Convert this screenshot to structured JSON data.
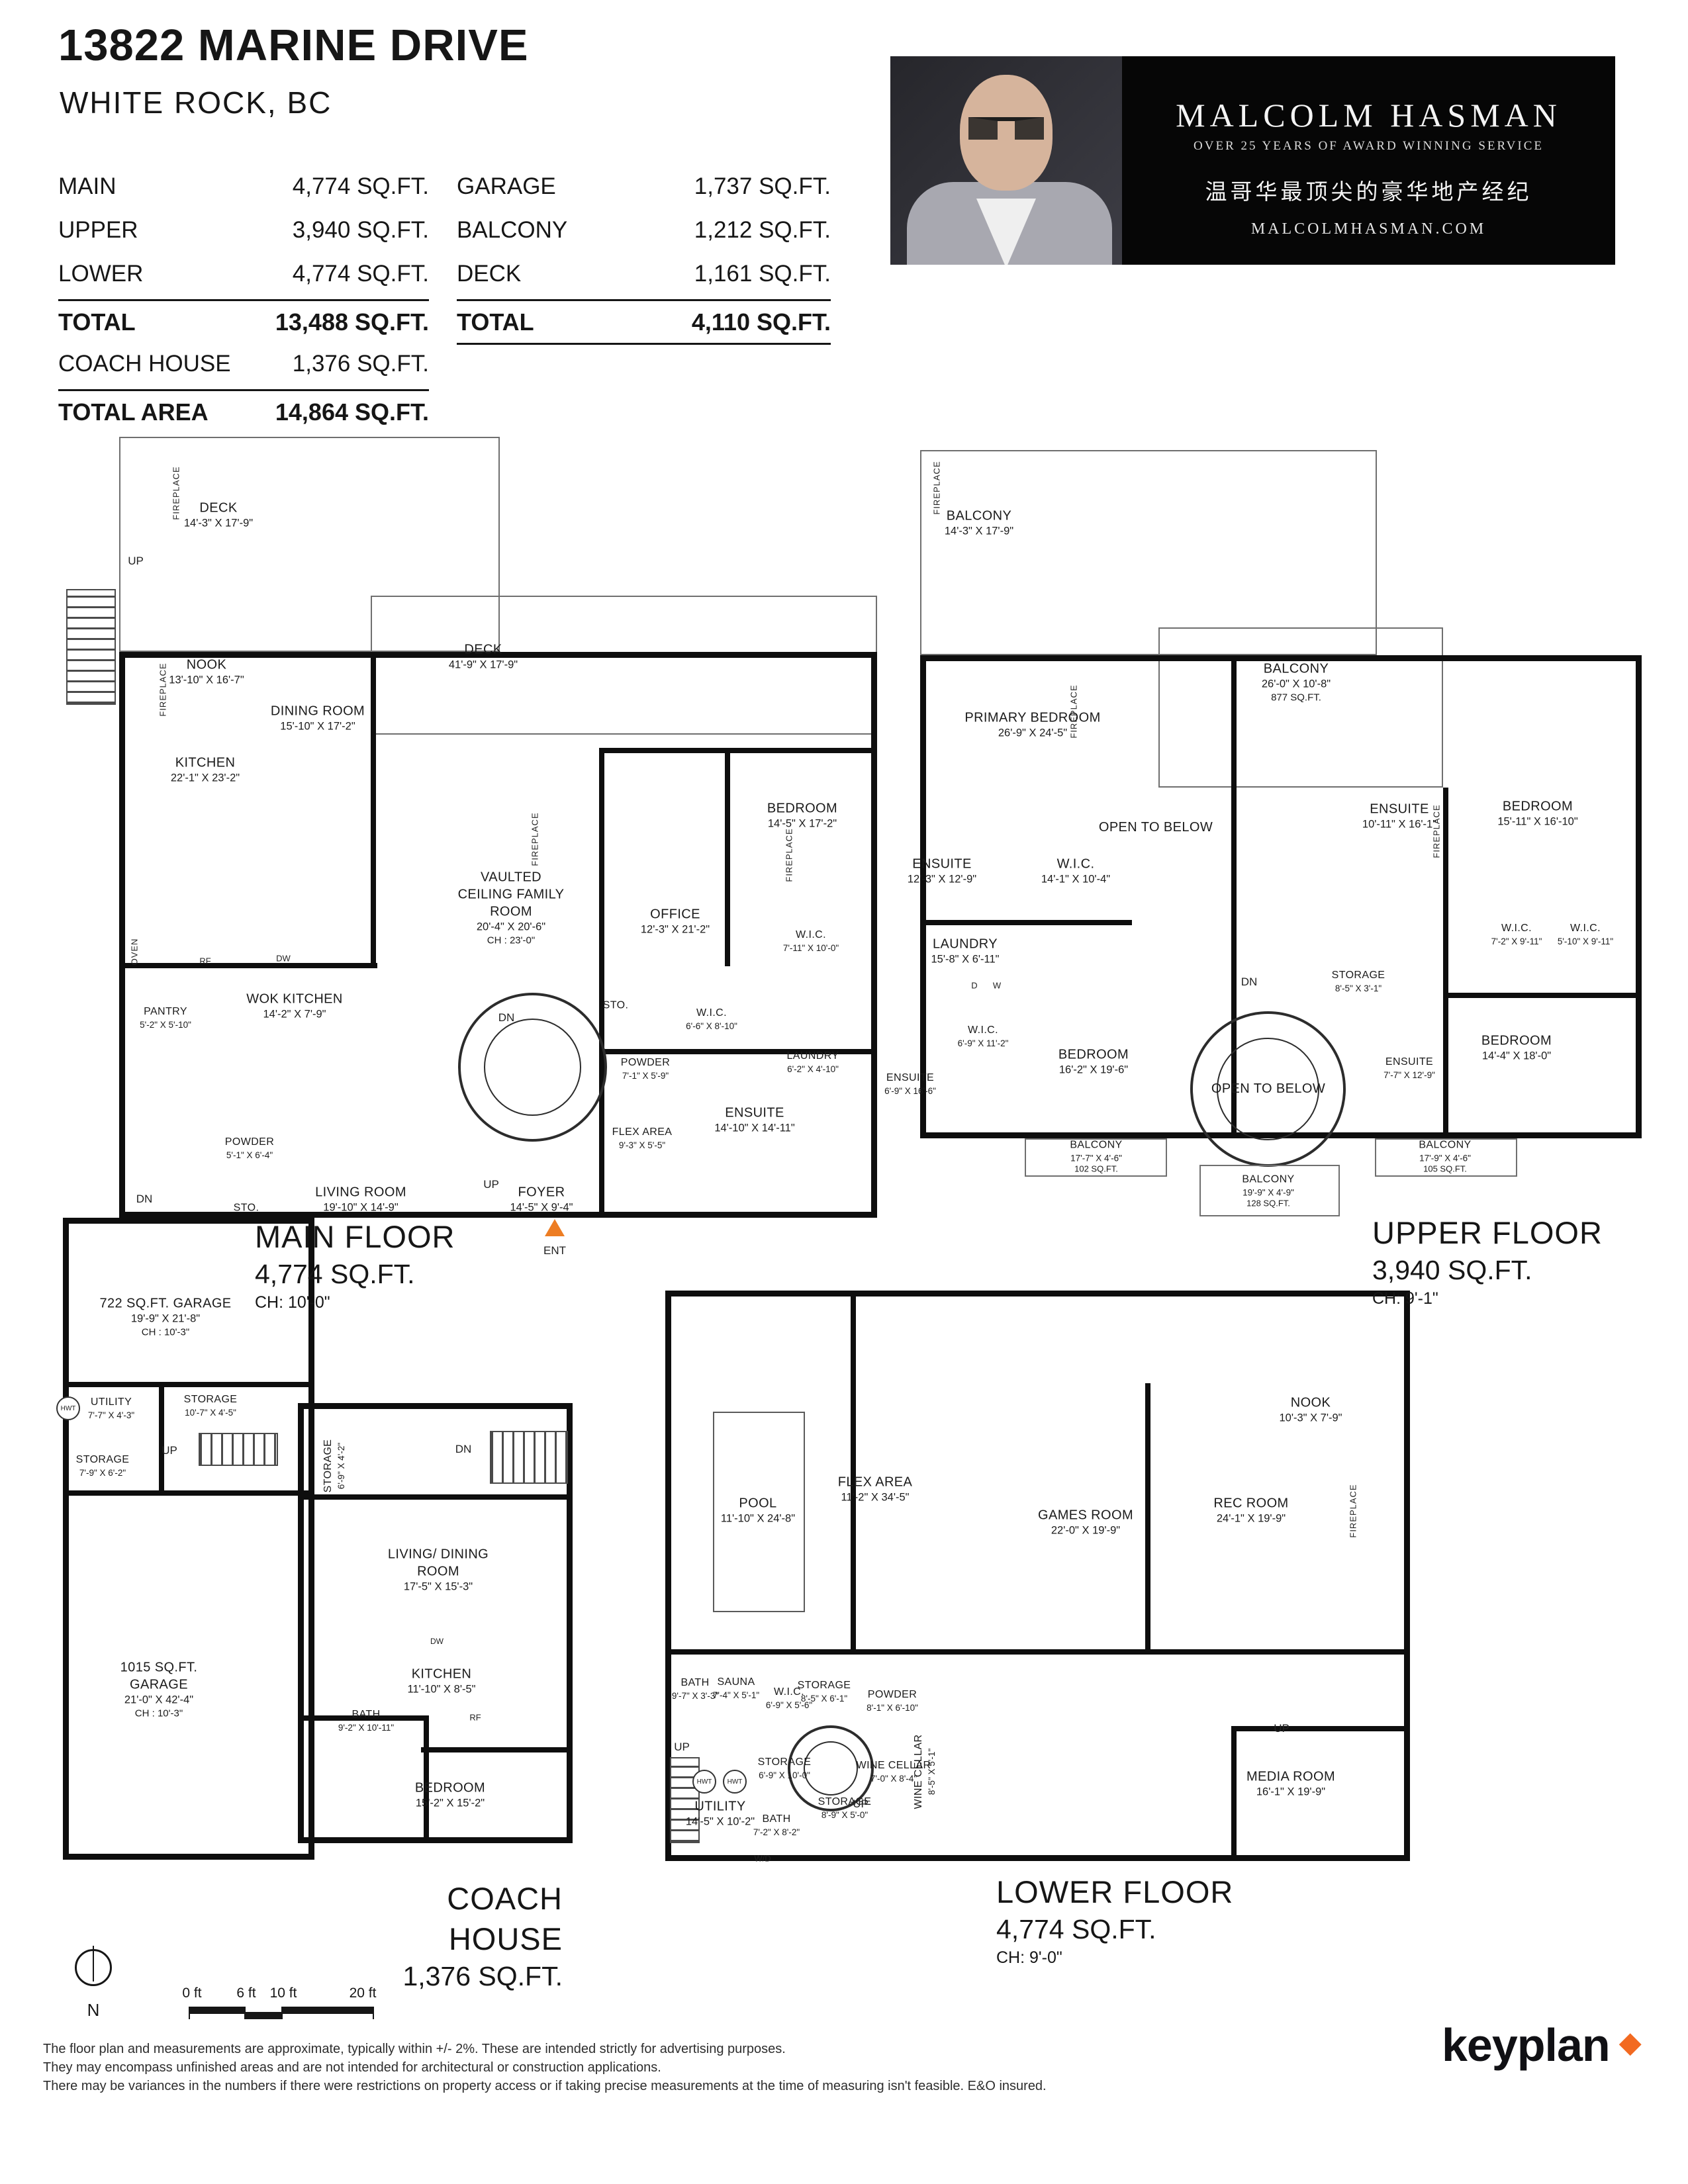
{
  "colors": {
    "accent_orange": "#ed7d23",
    "banner_bg": "#060606"
  },
  "header": {
    "title": "13822 MARINE DRIVE",
    "subtitle": "WHITE ROCK, BC",
    "left_table": {
      "rows": [
        {
          "label": "MAIN",
          "value": "4,774 SQ.FT."
        },
        {
          "label": "UPPER",
          "value": "3,940 SQ.FT."
        },
        {
          "label": "LOWER",
          "value": "4,774 SQ.FT."
        }
      ],
      "total": {
        "label": "TOTAL",
        "value": "13,488 SQ.FT."
      },
      "coach": {
        "label": "COACH HOUSE",
        "value": "1,376 SQ.FT."
      },
      "total_area": {
        "label": "TOTAL AREA",
        "value": "14,864 SQ.FT."
      }
    },
    "right_table": {
      "rows": [
        {
          "label": "GARAGE",
          "value": "1,737 SQ.FT."
        },
        {
          "label": "BALCONY",
          "value": "1,212 SQ.FT."
        },
        {
          "label": "DECK",
          "value": "1,161 SQ.FT."
        }
      ],
      "total": {
        "label": "TOTAL",
        "value": "4,110 SQ.FT."
      }
    }
  },
  "banner": {
    "name": "MALCOLM HASMAN",
    "tagline": "OVER 25 YEARS OF AWARD WINNING SERVICE",
    "tagline_cn": "温哥华最顶尖的豪华地产经纪",
    "website": "MALCOLMHASMAN.COM"
  },
  "floors": {
    "main": {
      "title": "MAIN FLOOR",
      "area": "4,774 SQ.FT.",
      "ceiling": "CH: 10'-0\"",
      "rooms": [
        {
          "name": "DECK",
          "dims": "14'-3\" X 17'-9\""
        },
        {
          "name": "NOOK",
          "dims": "13'-10\" X 16'-7\""
        },
        {
          "name": "DINING ROOM",
          "dims": "15'-10\" X 17'-2\""
        },
        {
          "name": "KITCHEN",
          "dims": "22'-1\" X 23'-2\""
        },
        {
          "name": "DECK",
          "dims": "41'-9\" X 17'-9\""
        },
        {
          "name": "VAULTED CEILING FAMILY ROOM",
          "dims": "20'-4\" X 20'-6\"",
          "extra": "CH : 23'-0\""
        },
        {
          "name": "OFFICE",
          "dims": "12'-3\" X 21'-2\""
        },
        {
          "name": "BEDROOM",
          "dims": "14'-5\" X 17'-2\""
        },
        {
          "name": "W.I.C.",
          "dims": "7'-11\" X 10'-0\""
        },
        {
          "name": "WOK KITCHEN",
          "dims": "14'-2\" X 7'-9\""
        },
        {
          "name": "PANTRY",
          "dims": "5'-2\" X 5'-10\""
        },
        {
          "name": "POWDER",
          "dims": "5'-1\" X 6'-4\""
        },
        {
          "name": "STO."
        },
        {
          "name": "LIVING ROOM",
          "dims": "19'-10\" X 14'-9\""
        },
        {
          "name": "FOYER",
          "dims": "14'-5\" X 9'-4\""
        },
        {
          "name": "FLEX AREA",
          "dims": "9'-3\" X 5'-5\""
        },
        {
          "name": "STO."
        },
        {
          "name": "W.I.C.",
          "dims": "6'-6\" X 8'-10\""
        },
        {
          "name": "POWDER",
          "dims": "7'-1\" X 5'-9\""
        },
        {
          "name": "LAUNDRY",
          "dims": "6'-2\" X 4'-10\""
        },
        {
          "name": "ENSUITE",
          "dims": "14'-10\" X 14'-11\""
        }
      ],
      "markers": [
        "UP",
        "DN",
        "UP",
        "DN",
        "ENT",
        "RF",
        "DW",
        "OVEN",
        "FIREPLACE",
        "FIREPLACE",
        "FIREPLACE",
        "FIREPLACE"
      ]
    },
    "upper": {
      "title": "UPPER FLOOR",
      "area": "3,940 SQ.FT.",
      "ceiling": "CH: 9'-1\"",
      "rooms": [
        {
          "name": "BALCONY",
          "dims": "14'-3\" X 17'-9\""
        },
        {
          "name": "PRIMARY BEDROOM",
          "dims": "26'-9\" X 24'-5\""
        },
        {
          "name": "BALCONY",
          "dims": "26'-0\" X 10'-8\"",
          "extra": "877 SQ.FT."
        },
        {
          "name": "ENSUITE",
          "dims": "10'-11\" X 16'-1\""
        },
        {
          "name": "BEDROOM",
          "dims": "15'-11\" X 16'-10\""
        },
        {
          "name": "OPEN TO BELOW"
        },
        {
          "name": "ENSUITE",
          "dims": "12'-3\" X 12'-9\""
        },
        {
          "name": "W.I.C.",
          "dims": "14'-1\" X 10'-4\""
        },
        {
          "name": "LAUNDRY",
          "dims": "15'-8\" X 6'-11\""
        },
        {
          "name": "STORAGE",
          "dims": "8'-5\" X 3'-1\""
        },
        {
          "name": "W.I.C.",
          "dims": "7'-2\" X 9'-11\""
        },
        {
          "name": "W.I.C.",
          "dims": "5'-10\" X 9'-11\""
        },
        {
          "name": "W.I.C.",
          "dims": "6'-9\" X 11'-2\""
        },
        {
          "name": "ENSUITE",
          "dims": "6'-9\" X 16'-6\""
        },
        {
          "name": "BEDROOM",
          "dims": "16'-2\" X 19'-6\""
        },
        {
          "name": "OPEN TO BELOW"
        },
        {
          "name": "ENSUITE",
          "dims": "7'-7\" X 12'-9\""
        },
        {
          "name": "BEDROOM",
          "dims": "14'-4\" X 18'-0\""
        },
        {
          "name": "BALCONY",
          "dims": "17'-7\" X 4'-6\"",
          "extra": "102 SQ.FT."
        },
        {
          "name": "BALCONY",
          "dims": "19'-9\" X 4'-9\"",
          "extra": "128 SQ.FT."
        },
        {
          "name": "BALCONY",
          "dims": "17'-9\" X 4'-6\"",
          "extra": "105 SQ.FT."
        }
      ],
      "markers": [
        "DN",
        "D",
        "W",
        "FIREPLACE",
        "FIREPLACE",
        "FIREPLACE"
      ]
    },
    "coach": {
      "title": "COACH HOUSE",
      "area": "1,376 SQ.FT.",
      "rooms": [
        {
          "name": "STORAGE",
          "dims": "6'-9\" X 4'-2\""
        },
        {
          "name": "LIVING/ DINING ROOM",
          "dims": "17'-5\" X 15'-3\""
        },
        {
          "name": "KITCHEN",
          "dims": "11'-10\" X 8'-5\""
        },
        {
          "name": "BATH",
          "dims": "9'-2\" X 10'-11\""
        },
        {
          "name": "BEDROOM",
          "dims": "15'-2\" X 15'-2\""
        }
      ],
      "markers": [
        "DN",
        "DW",
        "RF"
      ]
    },
    "garage": {
      "rooms": [
        {
          "name": "722 SQ.FT. GARAGE",
          "dims": "19'-9\" X 21'-8\"",
          "extra": "CH : 10'-3\""
        },
        {
          "name": "UTILITY",
          "dims": "7'-7\" X 4'-3\""
        },
        {
          "name": "STORAGE",
          "dims": "10'-7\" X 4'-5\""
        },
        {
          "name": "STORAGE",
          "dims": "7'-9\" X 6'-2\""
        },
        {
          "name": "1015 SQ.FT. GARAGE",
          "dims": "21'-0\" X 42'-4\"",
          "extra": "CH : 10'-3\""
        }
      ],
      "markers": [
        "UP",
        "HWT"
      ]
    },
    "lower": {
      "title": "LOWER FLOOR",
      "area": "4,774 SQ.FT.",
      "ceiling": "CH: 9'-0\"",
      "rooms": [
        {
          "name": "POOL",
          "dims": "11'-10\" X 24'-8\""
        },
        {
          "name": "FLEX AREA",
          "dims": "11'-2\" X 34'-5\""
        },
        {
          "name": "GAMES ROOM",
          "dims": "22'-0\" X 19'-9\""
        },
        {
          "name": "REC ROOM",
          "dims": "24'-1\" X 19'-9\""
        },
        {
          "name": "NOOK",
          "dims": "10'-3\" X 7'-9\""
        },
        {
          "name": "BATH",
          "dims": "9'-7\" X 3'-3\""
        },
        {
          "name": "SAUNA",
          "dims": "7'-4\" X 5'-1\""
        },
        {
          "name": "W.I.C.",
          "dims": "6'-9\" X 5'-6\""
        },
        {
          "name": "STORAGE",
          "dims": "8'-5\" X 6'-1\""
        },
        {
          "name": "POWDER",
          "dims": "8'-1\" X 6'-10\""
        },
        {
          "name": "STORAGE",
          "dims": "6'-9\" X 10'-0\""
        },
        {
          "name": "WINE CELLAR",
          "dims": "7'-0\" X 8'-4\""
        },
        {
          "name": "WINE CELLAR",
          "dims": "8'-5\" X 5'-1\""
        },
        {
          "name": "UTILITY",
          "dims": "14'-5\" X 10'-2\""
        },
        {
          "name": "BATH",
          "dims": "7'-2\" X 8'-2\""
        },
        {
          "name": "STORAGE",
          "dims": "8'-9\" X 5'-0\""
        },
        {
          "name": "MEDIA ROOM",
          "dims": "16'-1\" X 19'-9\""
        }
      ],
      "markers": [
        "UP",
        "UP",
        "UP",
        "W/D",
        "FIREPLACE",
        "HWT",
        "HWT"
      ]
    }
  },
  "footer": {
    "scale_labels": [
      "0 ft",
      "6 ft",
      "10 ft",
      "20 ft"
    ],
    "north": "N",
    "disclaimer": [
      "The floor plan and measurements are approximate, typically within +/- 2%. These are intended strictly for advertising purposes.",
      "They may encompass unfinished areas and are not intended for architectural or construction applications.",
      "There may be variances in the numbers if there were restrictions on property access or if taking precise measurements at the time of measuring isn't feasible. E&O insured."
    ],
    "logo": "keyplan"
  }
}
